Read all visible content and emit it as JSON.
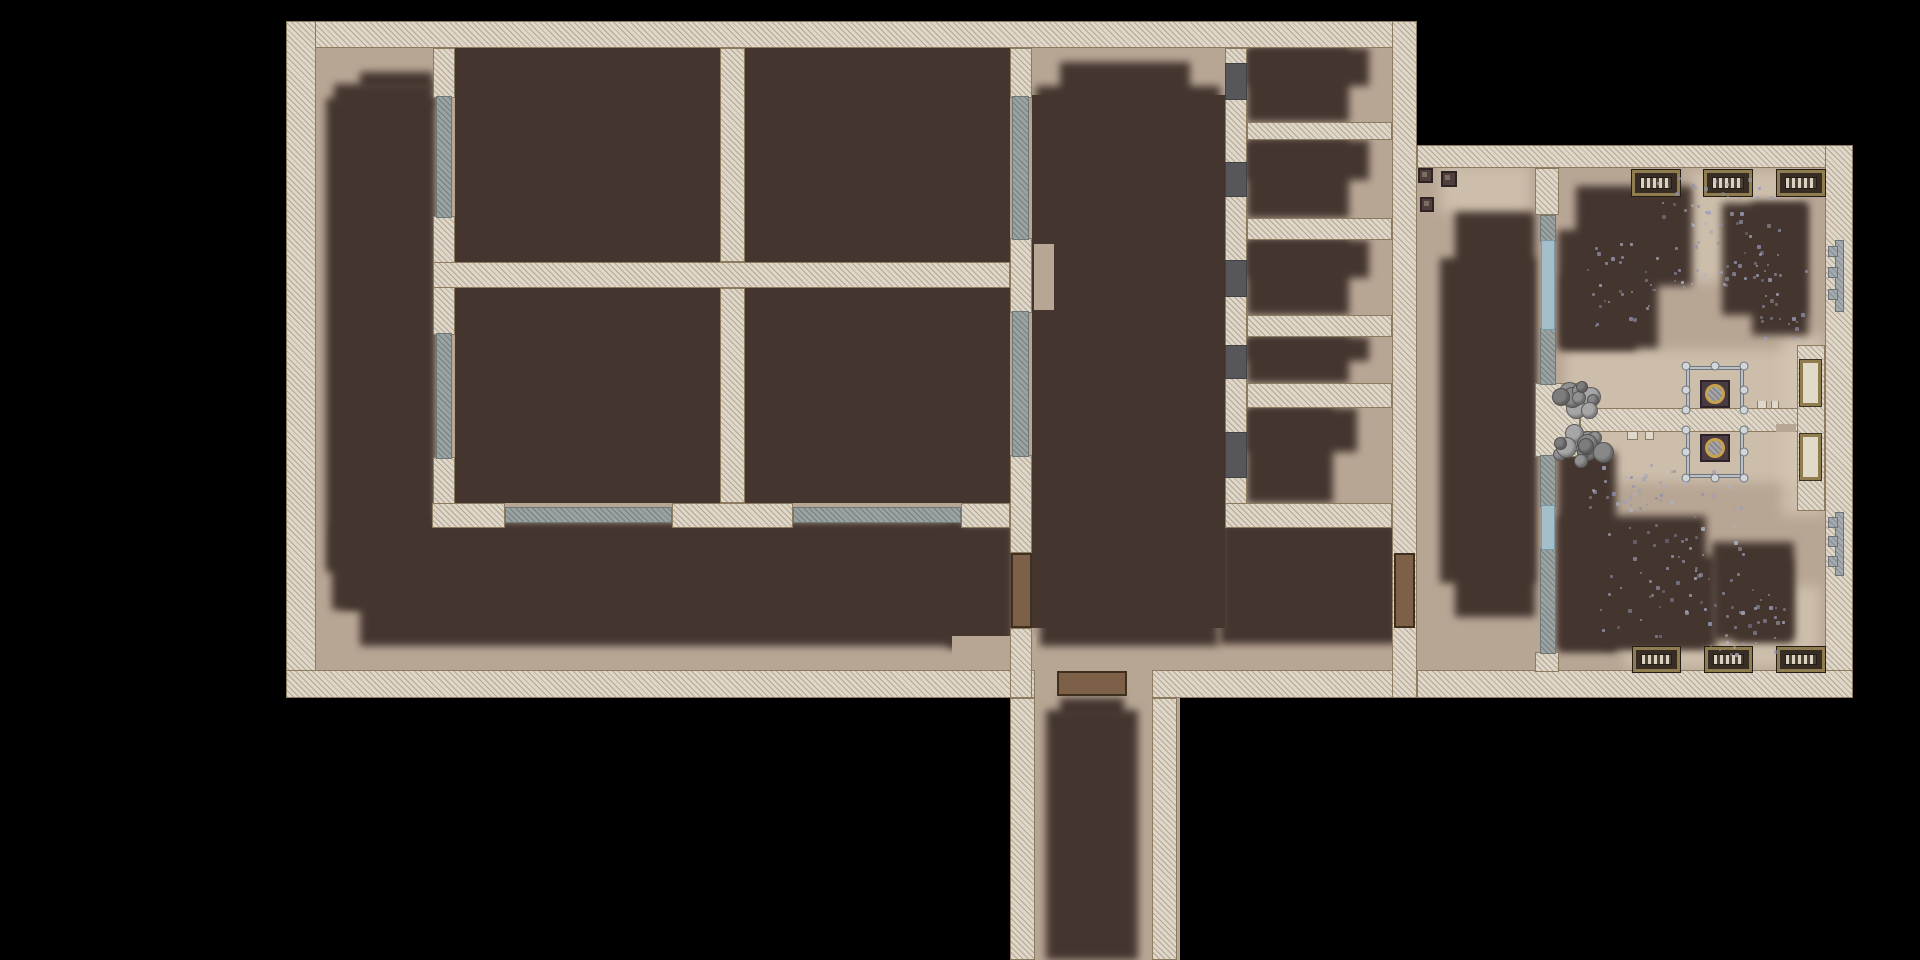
{
  "palette": {
    "bg": "#000000",
    "floor": "#b8a695",
    "floorLight": "#d6c8b5",
    "fog": "#44362f",
    "wall": "#ded7ca",
    "wallHatch": "#b4a791",
    "wallEdge": "#8c7b5f",
    "gray": "#9ba2a2",
    "grayHatch": "#76807f",
    "grayEdge": "#6e7878",
    "blue": "#a3bfcb",
    "blueEdge": "#7e98a4",
    "arch": "#56565b",
    "door": "#7c6047",
    "doorEdge": "#3f2f1e",
    "caseFill": "#e2dac8",
    "benchFrame": "#8f7d50",
    "benchDark": "#382d25",
    "benchDark2": "#4c4136",
    "benchLight": "#dbd2c2",
    "crate": "#513f3f",
    "crateEdge": "#2f2424",
    "crateNotch": "#7d6c60",
    "rail": "#bac0c5",
    "railEdge": "#6e767c",
    "knob": "#d0d6da",
    "brazBox": "#4a3a41",
    "brazEdge": "#2c2227",
    "ring": "#c7a24b",
    "stair": "#a4aaae",
    "stairEdge": "#6d7478",
    "boulders": [
      "#919191",
      "#7d7d7d",
      "#a6a6a6",
      "#888888"
    ],
    "debris": [
      "#9c9dbb",
      "#8d8ead",
      "#b0b1c8"
    ]
  },
  "map": {
    "floors": [
      {
        "x": 312,
        "y": 44,
        "w": 1086,
        "h": 630
      },
      {
        "x": 1417,
        "y": 164,
        "w": 412,
        "h": 510
      },
      {
        "x": 1032,
        "y": 674,
        "w": 148,
        "h": 286
      }
    ],
    "floor_patches": [
      {
        "x": 1690,
        "y": 170,
        "w": 112,
        "h": 112
      },
      {
        "x": 1565,
        "y": 350,
        "w": 250,
        "h": 132
      },
      {
        "x": 1625,
        "y": 586,
        "w": 195,
        "h": 82
      },
      {
        "x": 1782,
        "y": 335,
        "w": 42,
        "h": 180
      },
      {
        "x": 1440,
        "y": 166,
        "w": 90,
        "h": 46
      }
    ],
    "fog_fill": [
      {
        "x": 455,
        "y": 48,
        "w": 265,
        "h": 214
      },
      {
        "x": 745,
        "y": 48,
        "w": 265,
        "h": 214
      },
      {
        "x": 455,
        "y": 288,
        "w": 265,
        "h": 215
      },
      {
        "x": 745,
        "y": 288,
        "w": 265,
        "h": 215
      },
      {
        "x": 1032,
        "y": 95,
        "w": 193,
        "h": 533
      }
    ],
    "fog_soft": [
      {
        "x": 326,
        "y": 98,
        "w": 107,
        "h": 474
      },
      {
        "x": 342,
        "y": 98,
        "w": 91,
        "h": 510
      },
      {
        "x": 334,
        "y": 84,
        "w": 99,
        "h": 22
      },
      {
        "x": 360,
        "y": 72,
        "w": 73,
        "h": 18
      },
      {
        "x": 332,
        "y": 524,
        "w": 630,
        "h": 86
      },
      {
        "x": 360,
        "y": 524,
        "w": 600,
        "h": 122
      },
      {
        "x": 948,
        "y": 524,
        "w": 66,
        "h": 124
      },
      {
        "x": 1220,
        "y": 522,
        "w": 178,
        "h": 122
      },
      {
        "x": 1036,
        "y": 86,
        "w": 184,
        "h": 26
      },
      {
        "x": 1060,
        "y": 62,
        "w": 130,
        "h": 38
      },
      {
        "x": 1040,
        "y": 616,
        "w": 178,
        "h": 30
      },
      {
        "x": 1046,
        "y": 710,
        "w": 92,
        "h": 250
      },
      {
        "x": 1060,
        "y": 698,
        "w": 64,
        "h": 20
      },
      {
        "x": 1247,
        "y": 48,
        "w": 102,
        "h": 74
      },
      {
        "x": 1247,
        "y": 48,
        "w": 122,
        "h": 38
      },
      {
        "x": 1247,
        "y": 140,
        "w": 102,
        "h": 78
      },
      {
        "x": 1247,
        "y": 140,
        "w": 122,
        "h": 40
      },
      {
        "x": 1247,
        "y": 240,
        "w": 102,
        "h": 75
      },
      {
        "x": 1247,
        "y": 240,
        "w": 122,
        "h": 38
      },
      {
        "x": 1247,
        "y": 337,
        "w": 102,
        "h": 46
      },
      {
        "x": 1247,
        "y": 337,
        "w": 122,
        "h": 24
      },
      {
        "x": 1247,
        "y": 408,
        "w": 86,
        "h": 95
      },
      {
        "x": 1247,
        "y": 408,
        "w": 110,
        "h": 44
      },
      {
        "x": 1455,
        "y": 212,
        "w": 80,
        "h": 405
      },
      {
        "x": 1440,
        "y": 258,
        "w": 95,
        "h": 325
      },
      {
        "x": 1576,
        "y": 186,
        "w": 116,
        "h": 100
      },
      {
        "x": 1558,
        "y": 230,
        "w": 78,
        "h": 120
      },
      {
        "x": 1562,
        "y": 276,
        "w": 96,
        "h": 72
      },
      {
        "x": 1558,
        "y": 452,
        "w": 58,
        "h": 200
      },
      {
        "x": 1558,
        "y": 516,
        "w": 148,
        "h": 132
      },
      {
        "x": 1604,
        "y": 556,
        "w": 112,
        "h": 92
      },
      {
        "x": 1712,
        "y": 542,
        "w": 82,
        "h": 98
      },
      {
        "x": 1734,
        "y": 558,
        "w": 58,
        "h": 84
      },
      {
        "x": 1722,
        "y": 203,
        "w": 84,
        "h": 112
      },
      {
        "x": 1752,
        "y": 203,
        "w": 56,
        "h": 132
      }
    ],
    "floor_reveals": [
      {
        "x": 952,
        "y": 636,
        "w": 84,
        "h": 38
      },
      {
        "x": 1034,
        "y": 244,
        "w": 20,
        "h": 66
      }
    ],
    "walls": [
      {
        "x": 286,
        "y": 21,
        "w": 1131,
        "h": 27
      },
      {
        "x": 286,
        "y": 21,
        "w": 30,
        "h": 677
      },
      {
        "x": 286,
        "y": 670,
        "w": 749,
        "h": 28
      },
      {
        "x": 1152,
        "y": 670,
        "w": 265,
        "h": 28
      },
      {
        "x": 1392,
        "y": 21,
        "w": 25,
        "h": 677
      },
      {
        "x": 1010,
        "y": 698,
        "w": 25,
        "h": 262
      },
      {
        "x": 1152,
        "y": 698,
        "w": 25,
        "h": 262
      },
      {
        "x": 433,
        "y": 48,
        "w": 22,
        "h": 50
      },
      {
        "x": 433,
        "y": 216,
        "w": 22,
        "h": 119
      },
      {
        "x": 433,
        "y": 457,
        "w": 22,
        "h": 48
      },
      {
        "x": 432,
        "y": 503,
        "w": 73,
        "h": 25
      },
      {
        "x": 672,
        "y": 503,
        "w": 121,
        "h": 25
      },
      {
        "x": 961,
        "y": 503,
        "w": 49,
        "h": 25
      },
      {
        "x": 433,
        "y": 262,
        "w": 577,
        "h": 26
      },
      {
        "x": 720,
        "y": 48,
        "w": 25,
        "h": 214
      },
      {
        "x": 720,
        "y": 288,
        "w": 25,
        "h": 215
      },
      {
        "x": 1010,
        "y": 48,
        "w": 22,
        "h": 50
      },
      {
        "x": 1010,
        "y": 238,
        "w": 22,
        "h": 75
      },
      {
        "x": 1010,
        "y": 455,
        "w": 22,
        "h": 98
      },
      {
        "x": 1010,
        "y": 628,
        "w": 22,
        "h": 70
      },
      {
        "x": 1225,
        "y": 48,
        "w": 22,
        "h": 480
      },
      {
        "x": 1247,
        "y": 122,
        "w": 145,
        "h": 18
      },
      {
        "x": 1247,
        "y": 218,
        "w": 145,
        "h": 22
      },
      {
        "x": 1247,
        "y": 315,
        "w": 145,
        "h": 22
      },
      {
        "x": 1247,
        "y": 383,
        "w": 145,
        "h": 25
      },
      {
        "x": 1225,
        "y": 503,
        "w": 167,
        "h": 25
      },
      {
        "x": 1417,
        "y": 145,
        "w": 436,
        "h": 23
      },
      {
        "x": 1825,
        "y": 145,
        "w": 28,
        "h": 553
      },
      {
        "x": 1417,
        "y": 670,
        "w": 436,
        "h": 28
      },
      {
        "x": 1535,
        "y": 168,
        "w": 24,
        "h": 47
      },
      {
        "x": 1535,
        "y": 383,
        "w": 45,
        "h": 74
      },
      {
        "x": 1535,
        "y": 652,
        "w": 24,
        "h": 20
      },
      {
        "x": 1580,
        "y": 408,
        "w": 245,
        "h": 24
      },
      {
        "x": 1797,
        "y": 345,
        "w": 28,
        "h": 166
      }
    ],
    "gray_partitions": [
      {
        "x": 436,
        "y": 96,
        "w": 16,
        "h": 122
      },
      {
        "x": 436,
        "y": 333,
        "w": 16,
        "h": 126
      },
      {
        "x": 505,
        "y": 507,
        "w": 167,
        "h": 16
      },
      {
        "x": 793,
        "y": 507,
        "w": 168,
        "h": 16
      },
      {
        "x": 1012,
        "y": 96,
        "w": 17,
        "h": 144
      },
      {
        "x": 1012,
        "y": 311,
        "w": 17,
        "h": 146
      },
      {
        "x": 1540,
        "y": 215,
        "w": 16,
        "h": 27
      },
      {
        "x": 1540,
        "y": 328,
        "w": 16,
        "h": 57
      },
      {
        "x": 1540,
        "y": 455,
        "w": 16,
        "h": 52
      },
      {
        "x": 1540,
        "y": 548,
        "w": 16,
        "h": 106
      }
    ],
    "windows": [
      {
        "x": 1541,
        "y": 240,
        "w": 14,
        "h": 90
      },
      {
        "x": 1541,
        "y": 505,
        "w": 14,
        "h": 45
      }
    ],
    "archways": [
      {
        "x": 1225,
        "y": 63,
        "w": 22,
        "h": 37
      },
      {
        "x": 1225,
        "y": 162,
        "w": 22,
        "h": 35
      },
      {
        "x": 1225,
        "y": 260,
        "w": 22,
        "h": 37
      },
      {
        "x": 1225,
        "y": 345,
        "w": 22,
        "h": 34
      },
      {
        "x": 1225,
        "y": 432,
        "w": 22,
        "h": 46
      }
    ],
    "wall_teeth": [
      {
        "x": 1757,
        "y": 401,
        "w": 10,
        "h": 8
      },
      {
        "x": 1771,
        "y": 401,
        "w": 8,
        "h": 8
      },
      {
        "x": 1627,
        "y": 432,
        "w": 11,
        "h": 8
      },
      {
        "x": 1645,
        "y": 432,
        "w": 9,
        "h": 8
      }
    ],
    "wall_gaps": [
      {
        "x": 1776,
        "y": 424,
        "w": 20,
        "h": 8
      }
    ],
    "doors": [
      {
        "x": 1011,
        "y": 553,
        "w": 21,
        "h": 75
      },
      {
        "x": 1394,
        "y": 553,
        "w": 21,
        "h": 75
      },
      {
        "x": 1057,
        "y": 671,
        "w": 70,
        "h": 25
      }
    ],
    "display_cases": [
      {
        "x": 1800,
        "y": 360,
        "w": 21,
        "h": 46
      },
      {
        "x": 1800,
        "y": 434,
        "w": 21,
        "h": 46
      }
    ],
    "stairs": [
      {
        "x": 1828,
        "y": 240,
        "w": 16,
        "h": 72
      },
      {
        "x": 1828,
        "y": 512,
        "w": 16,
        "h": 64
      }
    ],
    "benches": [
      {
        "x": 1632,
        "y": 170,
        "w": 48,
        "h": 26
      },
      {
        "x": 1704,
        "y": 170,
        "w": 48,
        "h": 26
      },
      {
        "x": 1777,
        "y": 170,
        "w": 48,
        "h": 26
      },
      {
        "x": 1633,
        "y": 647,
        "w": 47,
        "h": 25
      },
      {
        "x": 1705,
        "y": 647,
        "w": 47,
        "h": 25
      },
      {
        "x": 1777,
        "y": 647,
        "w": 48,
        "h": 25
      }
    ],
    "crates": [
      {
        "x": 1418,
        "y": 168,
        "w": 15,
        "h": 15
      },
      {
        "x": 1441,
        "y": 171,
        "w": 16,
        "h": 16
      },
      {
        "x": 1420,
        "y": 197,
        "w": 14,
        "h": 15
      }
    ],
    "braziers": [
      {
        "x": 1700,
        "y": 380,
        "w": 30,
        "h": 28
      },
      {
        "x": 1700,
        "y": 434,
        "w": 30,
        "h": 28
      }
    ],
    "railings": [
      {
        "x": 1686,
        "y": 366,
        "w": 58,
        "h": 44,
        "open": "bottom"
      },
      {
        "x": 1686,
        "y": 430,
        "w": 58,
        "h": 48,
        "open": "top"
      }
    ],
    "boulder_clusters": [
      {
        "cx": 1578,
        "cy": 396,
        "n": 11,
        "spread": 26
      },
      {
        "cx": 1584,
        "cy": 445,
        "n": 14,
        "spread": 30
      }
    ],
    "debris_patches": [
      {
        "x": 1655,
        "y": 172,
        "w": 125,
        "h": 115,
        "n": 70
      },
      {
        "x": 1585,
        "y": 240,
        "w": 70,
        "h": 85,
        "n": 28
      },
      {
        "x": 1588,
        "y": 462,
        "w": 85,
        "h": 48,
        "n": 26
      },
      {
        "x": 1600,
        "y": 470,
        "w": 145,
        "h": 165,
        "n": 75
      },
      {
        "x": 1700,
        "y": 588,
        "w": 85,
        "h": 68,
        "n": 32
      },
      {
        "x": 1748,
        "y": 248,
        "w": 58,
        "h": 92,
        "n": 26
      }
    ]
  }
}
